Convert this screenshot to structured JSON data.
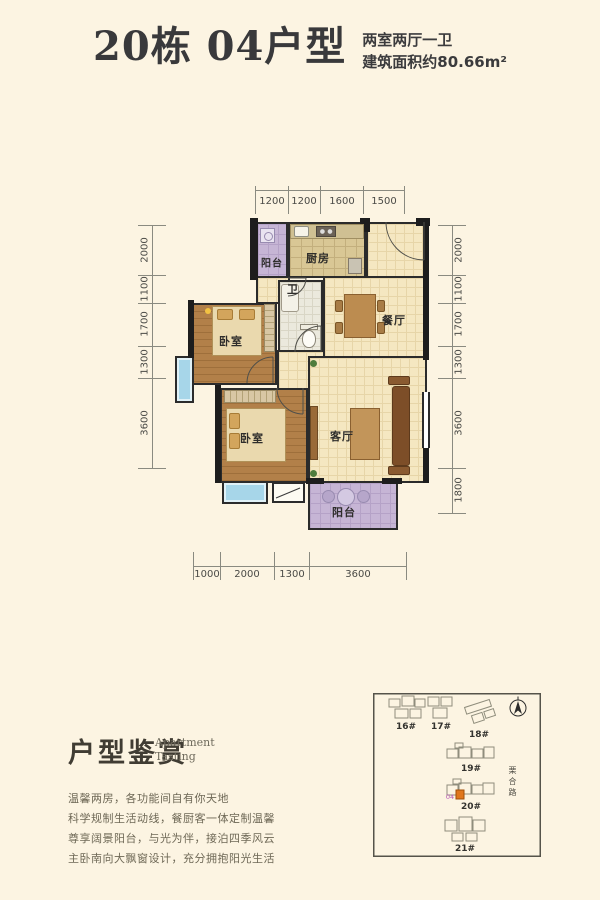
{
  "header": {
    "title": "20栋 04户型",
    "spec": "两室两厅一卫",
    "area": "建筑面积约80.66m²"
  },
  "plan": {
    "rooms": {
      "balcony_top": "阳台",
      "kitchen": "厨房",
      "bath": "卫",
      "dining": "餐厅",
      "bedroom_upper": "卧室",
      "bedroom_lower": "卧室",
      "living": "客厅",
      "balcony_bottom": "阳台"
    },
    "dims_top": [
      "1200",
      "1200",
      "1600",
      "1500"
    ],
    "dims_left": [
      "2000",
      "1100",
      "1700",
      "1300",
      "3600"
    ],
    "dims_right": [
      "2000",
      "1100",
      "1700",
      "1300",
      "3600",
      "1800"
    ],
    "dims_bottom": [
      "1000",
      "2000",
      "1300",
      "3600"
    ]
  },
  "section": {
    "title": "户型鉴赏",
    "subtitle_en_1": "Apartment",
    "subtitle_en_2": "Tasting",
    "lines": [
      "温馨两房，各功能间自有你天地",
      "科学规制生活动线，餐厨客一体定制温馨",
      "尊享阔景阳台，与光为伴，接泊四季风云",
      "主卧南向大飘窗设计，充分拥抱阳光生活"
    ]
  },
  "sitemap": {
    "buildings": [
      "16#",
      "17#",
      "18#",
      "19#",
      "20#",
      "21#"
    ],
    "unit_label": "04",
    "road": "栗合路"
  },
  "colors": {
    "background": "#fcf4e2",
    "wall": "#1d1d1d",
    "balcony_floor": "#c6b5d5",
    "bay_window": "#a7d6e9",
    "wood_floor": "#b28049",
    "tile_floor": "#f5e7c1",
    "highlight_unit": "#e0761c"
  }
}
